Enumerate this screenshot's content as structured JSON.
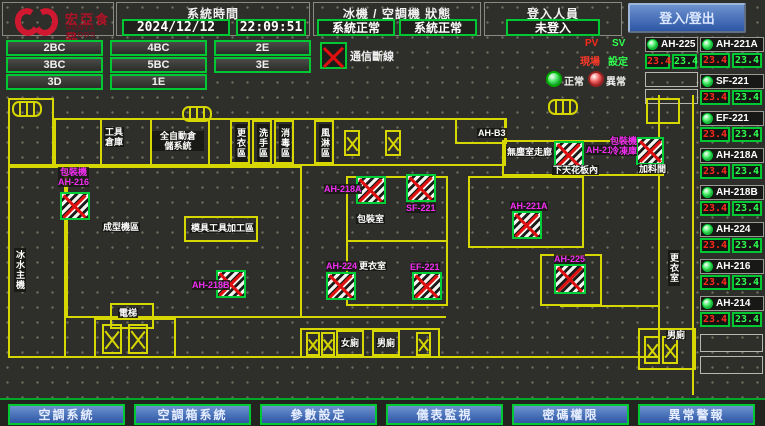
{
  "header": {
    "brand": {
      "name": "宏亞食品",
      "sub": "HUNYA FOODS"
    },
    "time_section": {
      "label": "系統時間",
      "date": "2024/12/12",
      "time": "22:09:51"
    },
    "status_section": {
      "label": "冰機 / 空調機 狀態",
      "chiller_status": "系統正常",
      "ahu_status": "系統正常"
    },
    "login_section": {
      "label": "登入人員",
      "value": "未登入"
    },
    "login_button": "登入/登出"
  },
  "floor_buttons": [
    "2BC",
    "4BC",
    "2E",
    "3BC",
    "5BC",
    "3E",
    "3D",
    "1E"
  ],
  "legend": {
    "comm_loss": "通信斷線",
    "pv": "PV",
    "sv": "SV",
    "pv_sub": "現場",
    "sv_sub": "設定",
    "normal": "正常",
    "abnormal": "異常"
  },
  "units_panel": {
    "left_unit": {
      "name": "AH-225",
      "pv": "23.4",
      "sv": "23.4"
    },
    "right_units": [
      {
        "name": "AH-221A",
        "pv": "23.4",
        "sv": "23.4"
      },
      {
        "name": "SF-221",
        "pv": "23.4",
        "sv": "23.4"
      },
      {
        "name": "EF-221",
        "pv": "23.4",
        "sv": "23.4"
      },
      {
        "name": "AH-218A",
        "pv": "23.4",
        "sv": "23.4"
      },
      {
        "name": "AH-218B",
        "pv": "23.4",
        "sv": "23.4"
      },
      {
        "name": "AH-224",
        "pv": "23.4",
        "sv": "23.4"
      },
      {
        "name": "AH-216",
        "pv": "23.4",
        "sv": "23.4"
      },
      {
        "name": "AH-214",
        "pv": "23.4",
        "sv": "23.4"
      }
    ]
  },
  "plan": {
    "rooms": {
      "tool": "工具\n倉庫",
      "auto_storage": "全自動倉\n儲系統",
      "v1": "更衣區",
      "v2": "洗手區",
      "v3": "消毒區",
      "v4": "風淋區",
      "ahb3": "AH-B3",
      "clean_corridor": "無塵室走廊",
      "ceiling": "下天花板內",
      "packing": "包裝室",
      "changing": "更衣室",
      "mold": "模具工具加工區",
      "forming": "成型機區",
      "chiller": "冰水主機",
      "elevator": "電梯",
      "feed": "加料間",
      "toilet_w": "女廁",
      "toilet_m": "男廁",
      "changing2": "更衣室",
      "toilet_m2": "男廁"
    },
    "unit_labels": {
      "i1": "包裝機\nAH-216",
      "i2": "AH-218A",
      "i3": "SF-221",
      "i4": "AH-218B",
      "i5": "AH-224",
      "i6": "EF-221",
      "i7": "AH-221A",
      "i8": "AH-214",
      "i9": "AH-225",
      "i10": "包裝機\n冷凍庫"
    }
  },
  "bottom_nav": [
    "空調系統",
    "空調箱系統",
    "參數設定",
    "儀表監視",
    "密碼權限",
    "異常警報"
  ],
  "colors": {
    "accent_green": "#00c832",
    "wall_yellow": "#d6d600",
    "unit_magenta": "#f22df2",
    "pv_red": "#ff2a1a",
    "sv_green": "#30ff50",
    "button_blue": "#2d56a5",
    "logo_red": "#d01830"
  }
}
